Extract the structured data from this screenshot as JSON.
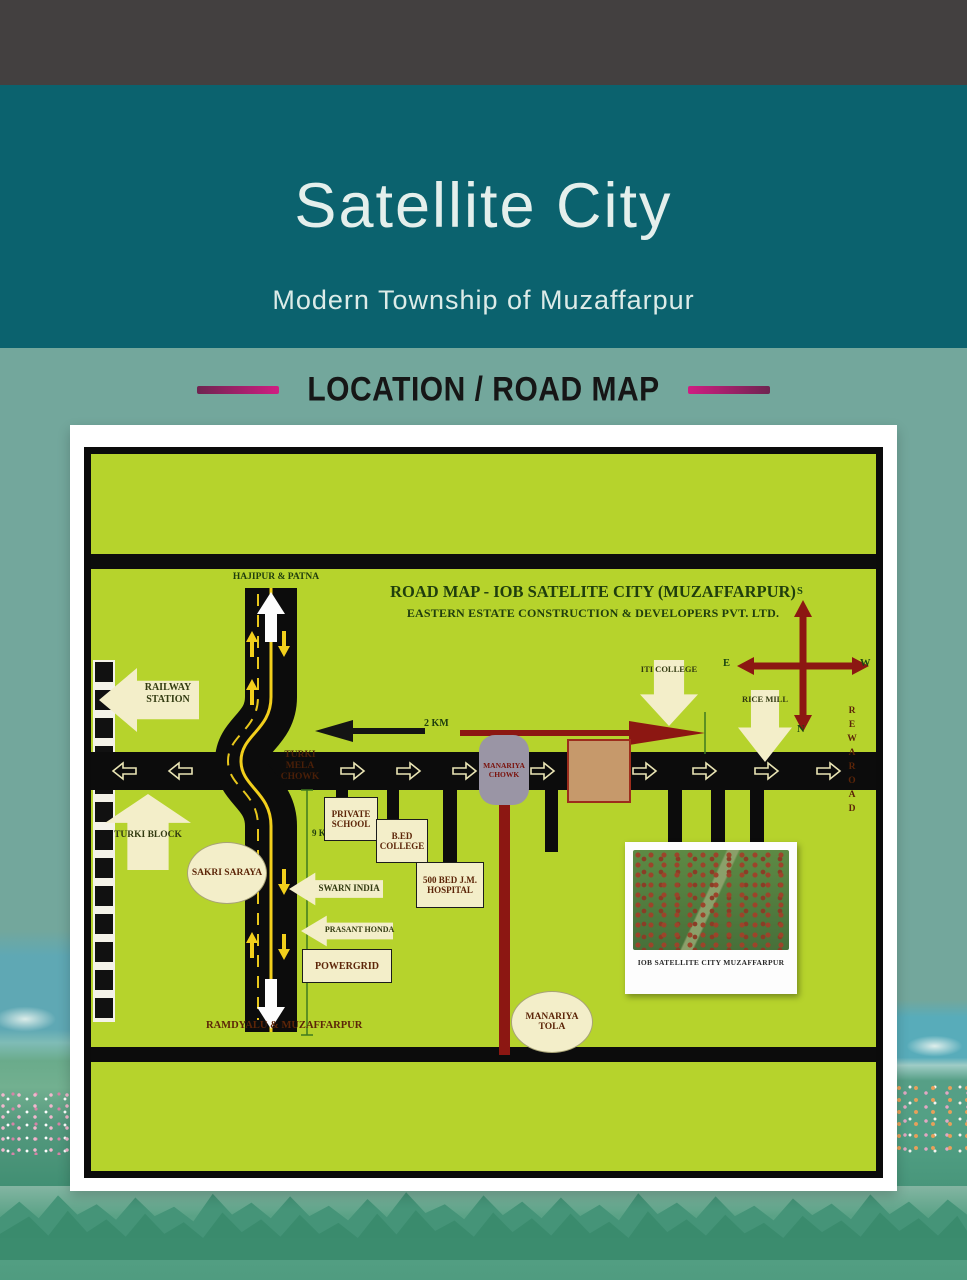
{
  "header": {
    "title": "Satellite City",
    "subtitle": "Modern Township of Muzaffarpur"
  },
  "section": {
    "heading": "LOCATION / ROAD MAP"
  },
  "map": {
    "title": "ROAD MAP - IOB  SATELITE CITY (MUZAFFARPUR)",
    "subtitle": "EASTERN ESTATE CONSTRUCTION & DEVELOPERS PVT. LTD.",
    "destinations": {
      "north": "HAJIPUR & PATNA",
      "south": "RAMDYALU & MUZAFFARPUR"
    },
    "junctions": {
      "turki_mela_chowk": "TURKI MELA CHOWK",
      "manariya_chowk": "MANARIYA CHOWK"
    },
    "places": {
      "railway_station": "RAILWAY STATION",
      "turki_block": "TURKI BLOCK",
      "sakri_saraya": "SAKRI SARAYA",
      "swarn_india": "SWARN INDIA",
      "prasant_honda": "PRASANT HONDA",
      "powergrid": "POWERGRID",
      "private_school": "PRIVATE SCHOOL",
      "bed_college": "B.ED COLLEGE",
      "jm_hospital": "500 BED J.M. HOSPITAL",
      "manariya_tola": "MANARIYA TOLA",
      "iti_college": "ITI COLLEGE",
      "rice_mill": "RICE MILL",
      "rewa_road": "REWAROAD"
    },
    "distances": {
      "east_west": "2 KM",
      "north_south": "9 KM"
    },
    "compass": {
      "top": "S",
      "left": "E",
      "right": "W",
      "bottom": "N"
    },
    "inset": {
      "caption": "IOB SATELLITE CITY MUZAFFARPUR"
    }
  },
  "colors": {
    "topbar": "#434040",
    "teal": "#0b626e",
    "sage": "#73a79c",
    "accent_pink": "#c9207e",
    "map_green": "#b6d32c",
    "road_black": "#0c0c0c",
    "dark_red": "#8c1712",
    "cream": "#f3eec9",
    "map_text_green": "#203e0d",
    "map_text_maroon": "#5c2508"
  }
}
